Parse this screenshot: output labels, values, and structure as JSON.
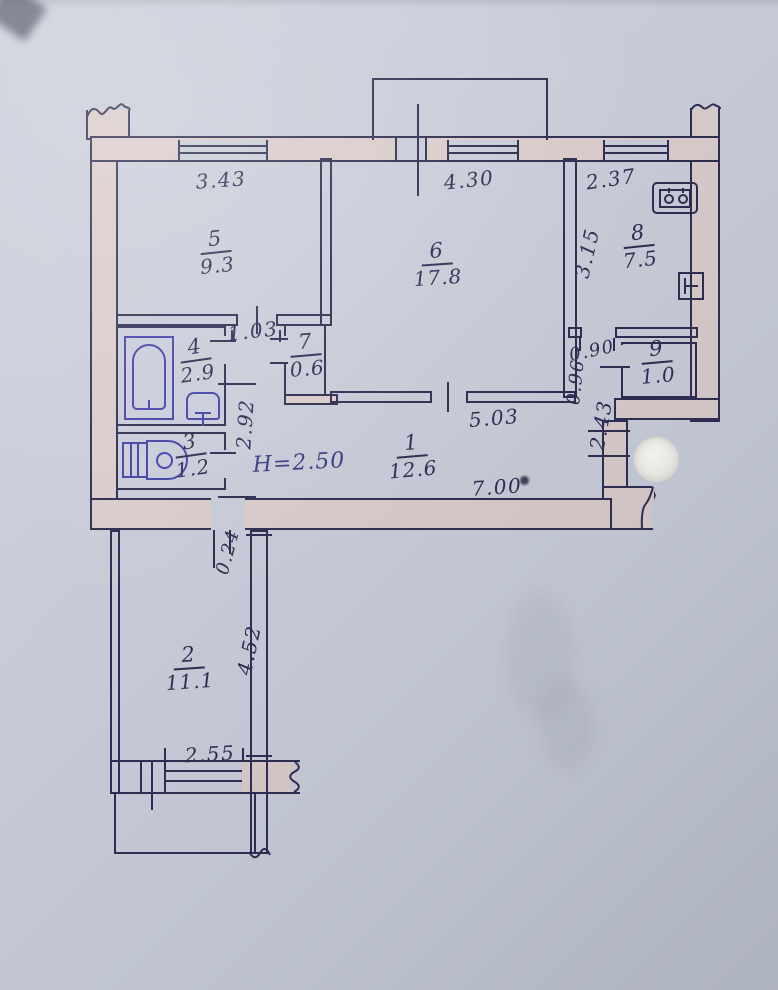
{
  "colors": {
    "paper": "#c8ccd8",
    "wall_fill": "#d9cbc9",
    "line": "#2e2c50",
    "ink": "#2d2d52",
    "blue_ink": "#4341a6",
    "h_ink": "#3a3a80",
    "whiteout": "#f6f5f1"
  },
  "rooms": [
    {
      "number": "1",
      "area": "12.6"
    },
    {
      "number": "2",
      "area": "11.1"
    },
    {
      "number": "3",
      "area": "1.2"
    },
    {
      "number": "4",
      "area": "2.9"
    },
    {
      "number": "5",
      "area": "9.3"
    },
    {
      "number": "6",
      "area": "17.8"
    },
    {
      "number": "7",
      "area": "0.6"
    },
    {
      "number": "8",
      "area": "7.5"
    },
    {
      "number": "9",
      "area": "1.0"
    }
  ],
  "dimensions": {
    "top_room5": "3.43",
    "top_room6": "4.30",
    "top_room8": "2.37",
    "room8_side": "3.15",
    "corridor": "1.03",
    "hall_left": "2.92",
    "hall_top": "5.03",
    "hall_bottom": "7.00",
    "kitchen_door": "0.90",
    "vestibule": "0.96",
    "entry": "2.43",
    "room2_offset": "0.24",
    "room2_side": "4.52",
    "room2_bottom": "2.55"
  },
  "annotations": {
    "ceiling_height": "H=2.50"
  },
  "icons": {
    "bathtub": "bathtub-icon",
    "bath_sink": "washbasin-icon",
    "toilet": "toilet-icon",
    "stove": "stove-icon",
    "kitchen_sink": "kitchen-sink-icon"
  }
}
